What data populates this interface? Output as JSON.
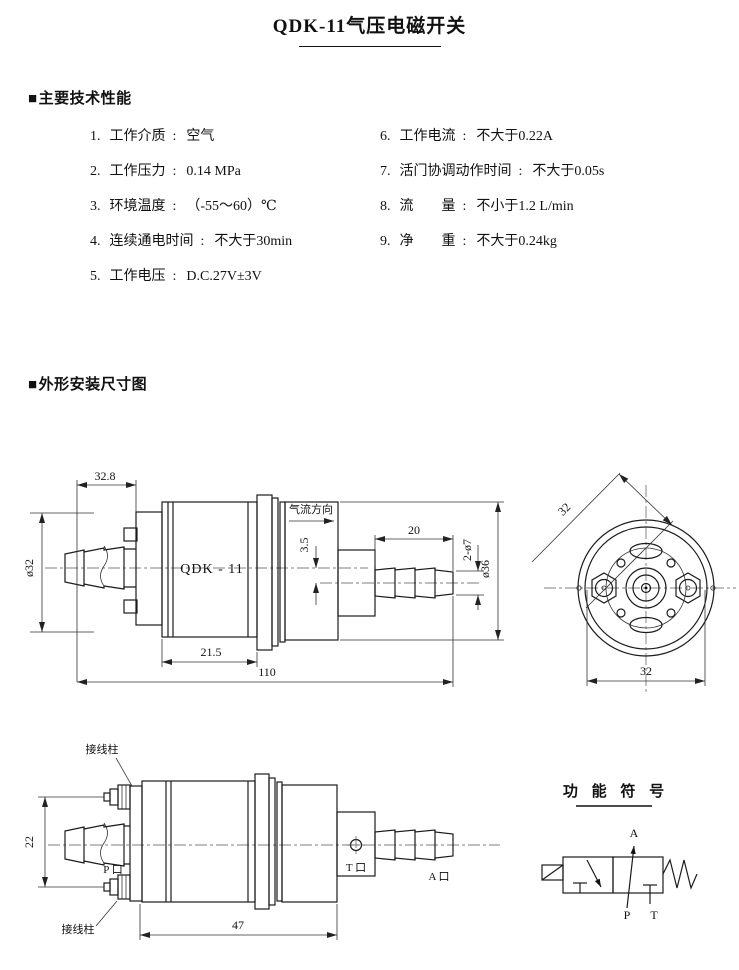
{
  "page": {
    "title": "QDK-11气压电磁开关"
  },
  "specs": {
    "bullet": "■",
    "heading": "主要技术性能",
    "colon": ":",
    "left": [
      {
        "num": "1.",
        "label": "工作介质",
        "value": "空气"
      },
      {
        "num": "2.",
        "label": "工作压力",
        "value": "0.14 MPa"
      },
      {
        "num": "3.",
        "label": "环境温度",
        "value": "（-55～60）℃"
      },
      {
        "num": "4.",
        "label": "连续通电时间",
        "value": "不大于30min"
      },
      {
        "num": "5.",
        "label": "工作电压",
        "value": "D.C.27V±3V"
      }
    ],
    "right": [
      {
        "num": "6.",
        "label": "工作电流",
        "value": "不大于0.22A"
      },
      {
        "num": "7.",
        "label": "活门协调动作时间",
        "value": "不大于0.05s"
      },
      {
        "num": "8.",
        "label": "流　　量",
        "value": "不小于1.2 L/min"
      },
      {
        "num": "9.",
        "label": "净　　重",
        "value": "不大于0.24kg"
      }
    ]
  },
  "dims_section": {
    "bullet": "■",
    "heading": "外形安装尺寸图"
  },
  "drawing_side_top": {
    "dim_rear_width": "32.8",
    "dia_rear": "ø32",
    "model": "QDK - 11",
    "airflow": "气流方向",
    "dim_axis_offset": "3.5",
    "dim_fitting_length": "20",
    "dim_port_dia": "2-ø7",
    "dia_body": "ø36",
    "dim_body_length": "21.5",
    "dim_overall_length": "110"
  },
  "drawing_front": {
    "dim_diagonal": "32",
    "dim_width": "32"
  },
  "drawing_side_bottom": {
    "terminal_top": "接线柱",
    "terminal_bottom": "接线柱",
    "dim_terminal_span": "22",
    "port_p": "P 口",
    "port_t": "T 口",
    "port_a": "A 口",
    "dim_body_length": "47"
  },
  "function_symbol": {
    "heading": "功 能 符 号",
    "port_a": "A",
    "port_p": "P",
    "port_t": "T"
  }
}
